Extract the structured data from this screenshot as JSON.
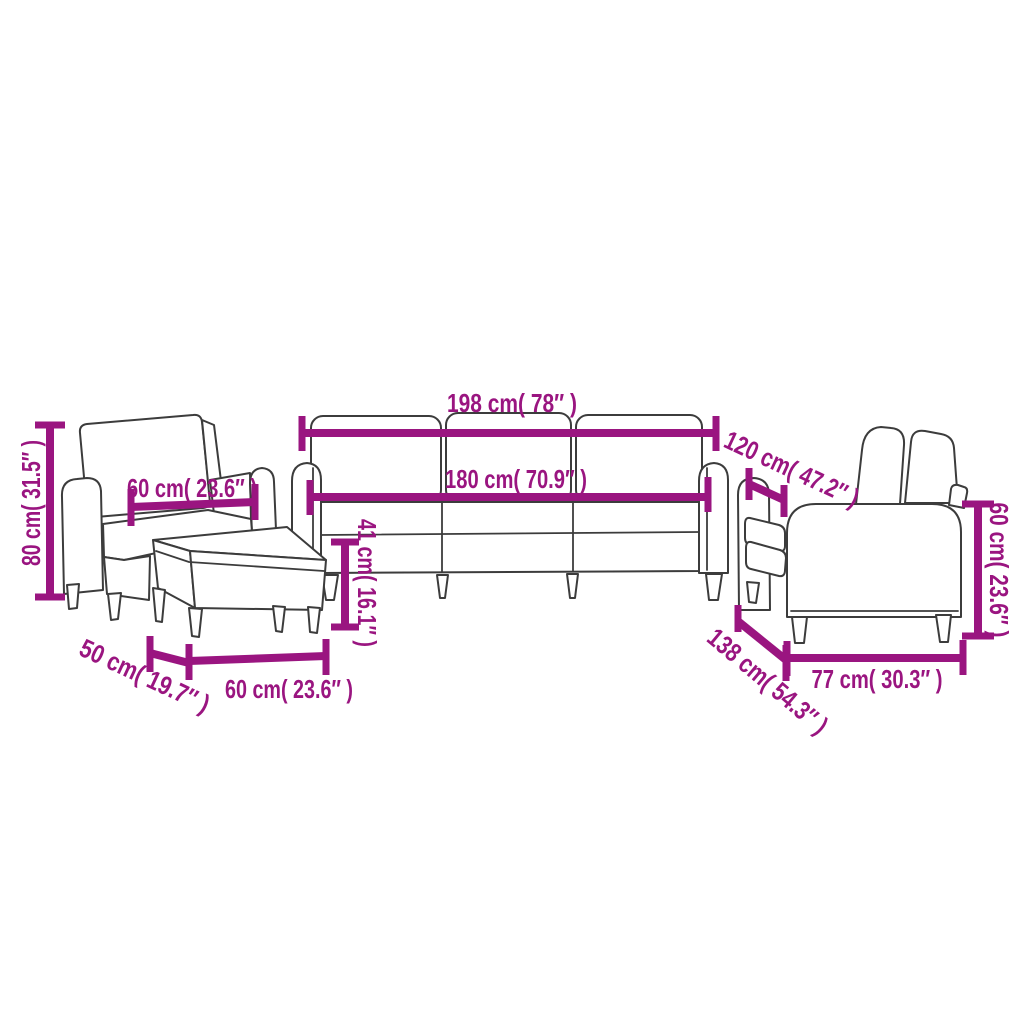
{
  "diagram": {
    "colors": {
      "dimension": "#9A1580",
      "outline": "#3C3C3C",
      "background": "#FFFFFF"
    },
    "pieces": {
      "armchair": {
        "height_label": "80 cm( 31.5″ )",
        "width_label": "60 cm( 23.6″ )"
      },
      "footstool": {
        "depth_label": "50 cm( 19.7″ )",
        "width_label": "60 cm( 23.6″ )"
      },
      "three_seater_sofa": {
        "overall_width_label": "198 cm( 78″ )",
        "seat_width_label": "180 cm( 70.9″ )",
        "seat_height_label": "41 cm( 16.1″ )",
        "depth_label": "120 cm( 47.2″ )"
      },
      "two_seater_sofa": {
        "back_height_label": "60 cm( 23.6″ )",
        "depth_label": "138 cm( 54.3″ )",
        "seat_width_label": "77 cm( 30.3″ )"
      }
    }
  }
}
